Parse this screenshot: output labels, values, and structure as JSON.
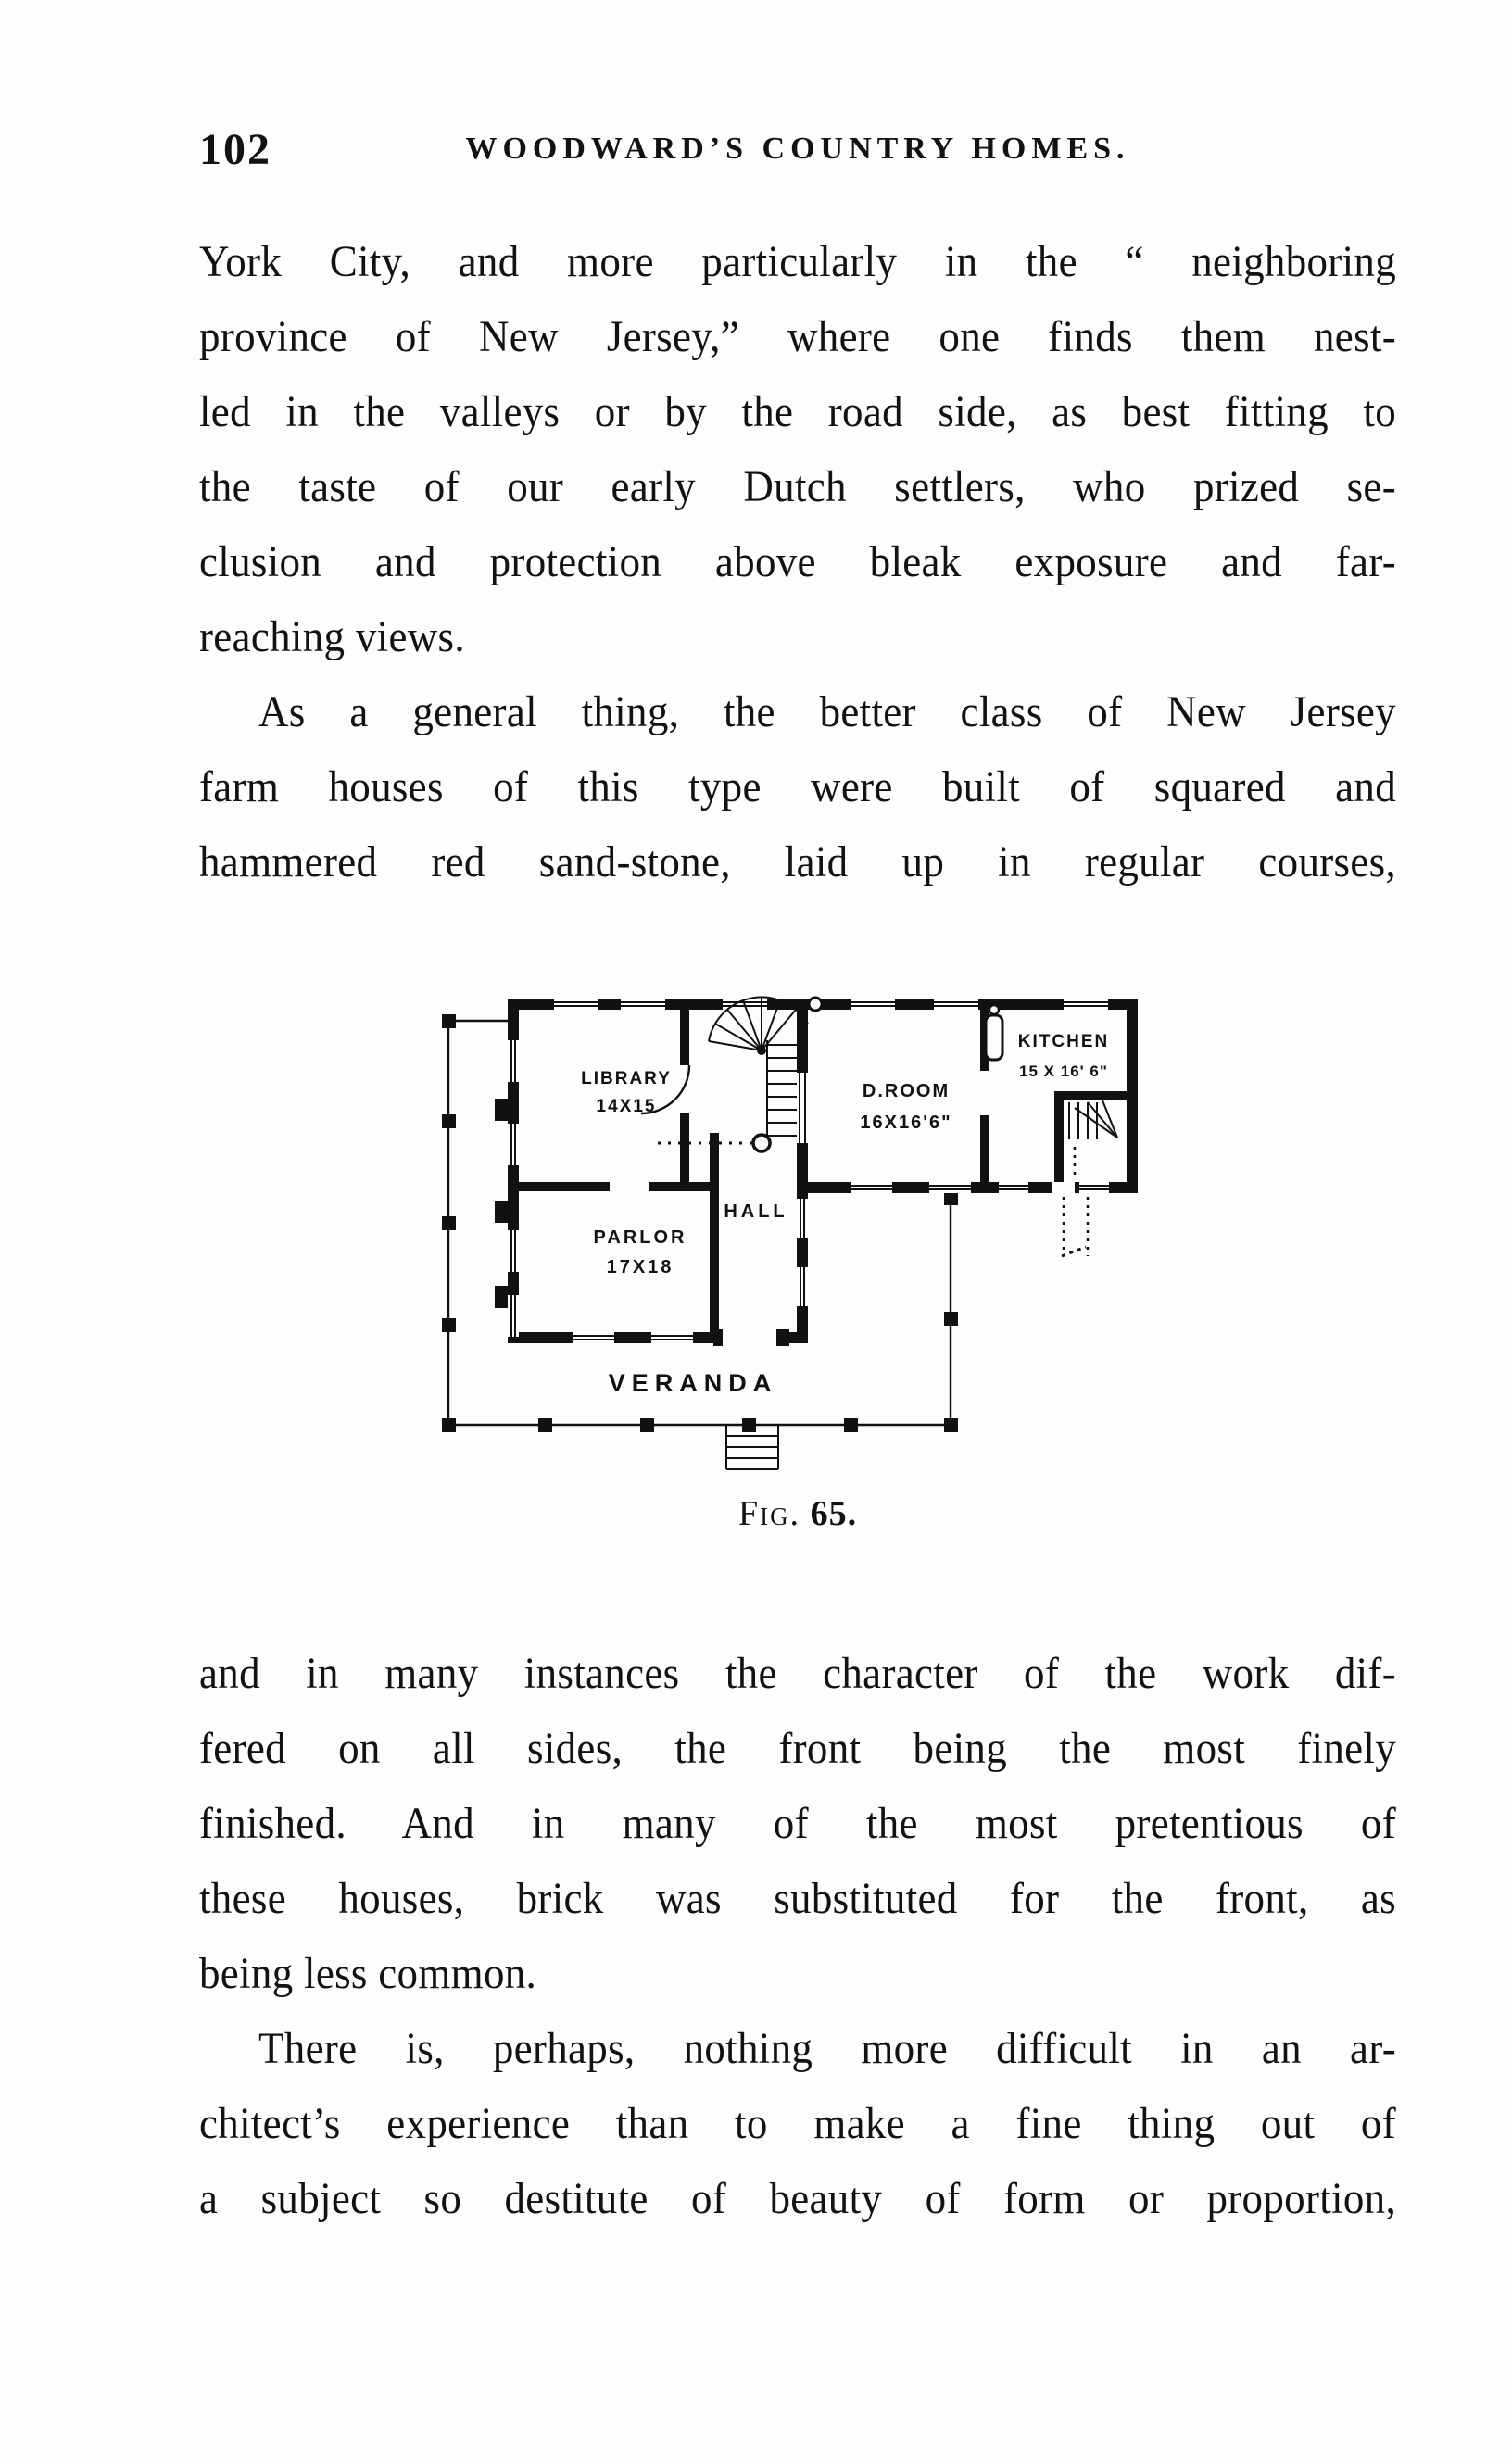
{
  "page": {
    "number": "102",
    "running_title": "WOODWARD’S COUNTRY HOMES."
  },
  "paragraphs": {
    "block1": [
      {
        "text": "York City, and more particularly in the “ neighboring"
      },
      {
        "text": "province of New Jersey,” where one finds them nest-"
      },
      {
        "text": "led in the valleys or by the road side, as best fitting to"
      },
      {
        "text": "the taste of our early Dutch settlers, who prized se-"
      },
      {
        "text": "clusion and protection above bleak exposure and far-"
      },
      {
        "text": "reaching views.",
        "end": true
      },
      {
        "text": "As a general thing, the better class of New Jersey",
        "indent": true
      },
      {
        "text": "farm houses of this type were built of squared and"
      },
      {
        "text": "hammered red sand-stone, laid up in regular courses,"
      }
    ],
    "block2": [
      {
        "text": "and in many instances the character of the work dif-"
      },
      {
        "text": "fered on all sides, the front being the most finely"
      },
      {
        "text": "finished. And in many of the most pretentious of"
      },
      {
        "text": "these houses, brick was substituted for the front, as"
      },
      {
        "text": "being less common.",
        "end": true
      },
      {
        "text": "There is, perhaps, nothing more difficult in an ar-",
        "indent": true
      },
      {
        "text": "chitect’s experience than to make a fine thing out of"
      },
      {
        "text": "a subject so destitute of beauty of form or proportion,"
      }
    ]
  },
  "figure": {
    "caption_label": "Fig.",
    "caption_number": "65.",
    "rooms": {
      "library": {
        "name": "LIBRARY",
        "dims": "14X15"
      },
      "parlor": {
        "name": "PARLOR",
        "dims": "17X18"
      },
      "hall": {
        "name": "HALL"
      },
      "dining": {
        "name": "D.ROOM",
        "dims": "16X16'6\""
      },
      "kitchen": {
        "name": "KITCHEN",
        "dims": "15 X 16' 6\""
      },
      "veranda": {
        "name": "VERANDA"
      }
    }
  },
  "colors": {
    "ink": "#111111",
    "paper": "#fdfdfb"
  }
}
